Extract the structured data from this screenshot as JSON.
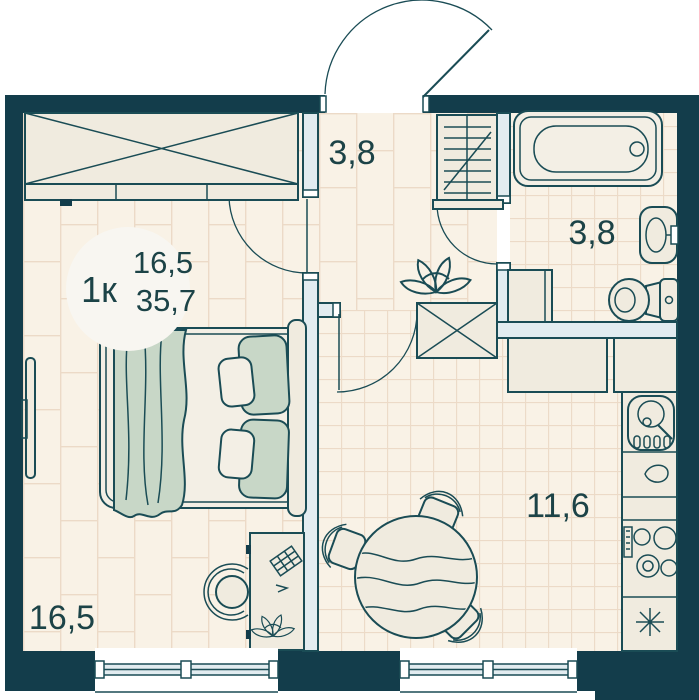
{
  "badge": {
    "type": "1к",
    "living_area": "16,5",
    "total_area": "35,7"
  },
  "rooms": {
    "hallway": {
      "area": "3,8"
    },
    "bathroom": {
      "area": "3,8"
    },
    "living": {
      "area": "16,5"
    },
    "kitchen": {
      "area": "11,6"
    }
  },
  "colors": {
    "wall": "#133d4b",
    "line": "#1a4c55",
    "floor_base": "#f9f2e6",
    "floor_line": "#ecdac7",
    "furniture_fill": "#f0ebdf",
    "soft_fill": "#f3efe5",
    "accent_sage": "#c8d7c7",
    "partition_fill": "#e2ecf0",
    "badge_fill": "#f8f6f1",
    "text": "#1c4347"
  }
}
